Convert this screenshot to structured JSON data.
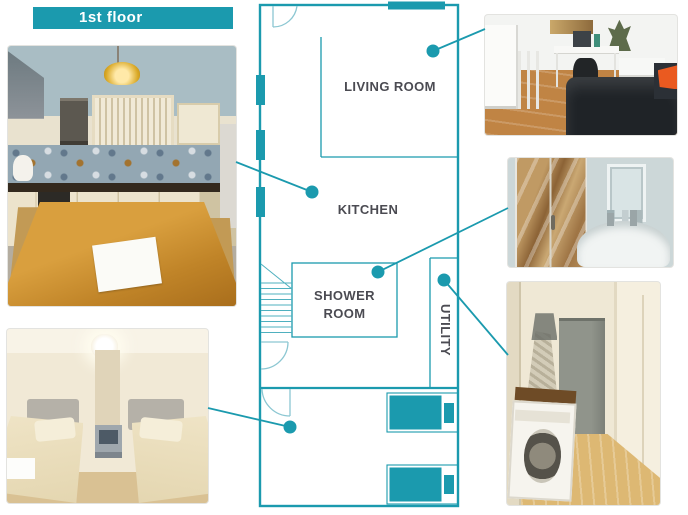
{
  "banner": {
    "label": "1st floor"
  },
  "colors": {
    "accent_teal": "#1b9aae",
    "door_arc_teal": "#8cc7d2",
    "label_text": "#4b4b52",
    "banner_bg": "#1b9aae",
    "banner_text": "#ffffff"
  },
  "floor_plan": {
    "labels": {
      "living_room": "LIVING ROOM",
      "kitchen": "KITCHEN",
      "shower_line1": "SHOWER",
      "shower_line2": "ROOM",
      "utility": "UTILITY"
    },
    "features": [
      "entrance-door",
      "hall-door",
      "bedroom-door",
      "stairs",
      "windows",
      "twin-beds"
    ]
  },
  "photos": {
    "kitchen": "kitchen-photo",
    "bedroom": "twin-bedroom-photo",
    "living_room": "living-room-photo",
    "shower_room": "shower-room-photo",
    "utility": "utility-room-photo"
  }
}
